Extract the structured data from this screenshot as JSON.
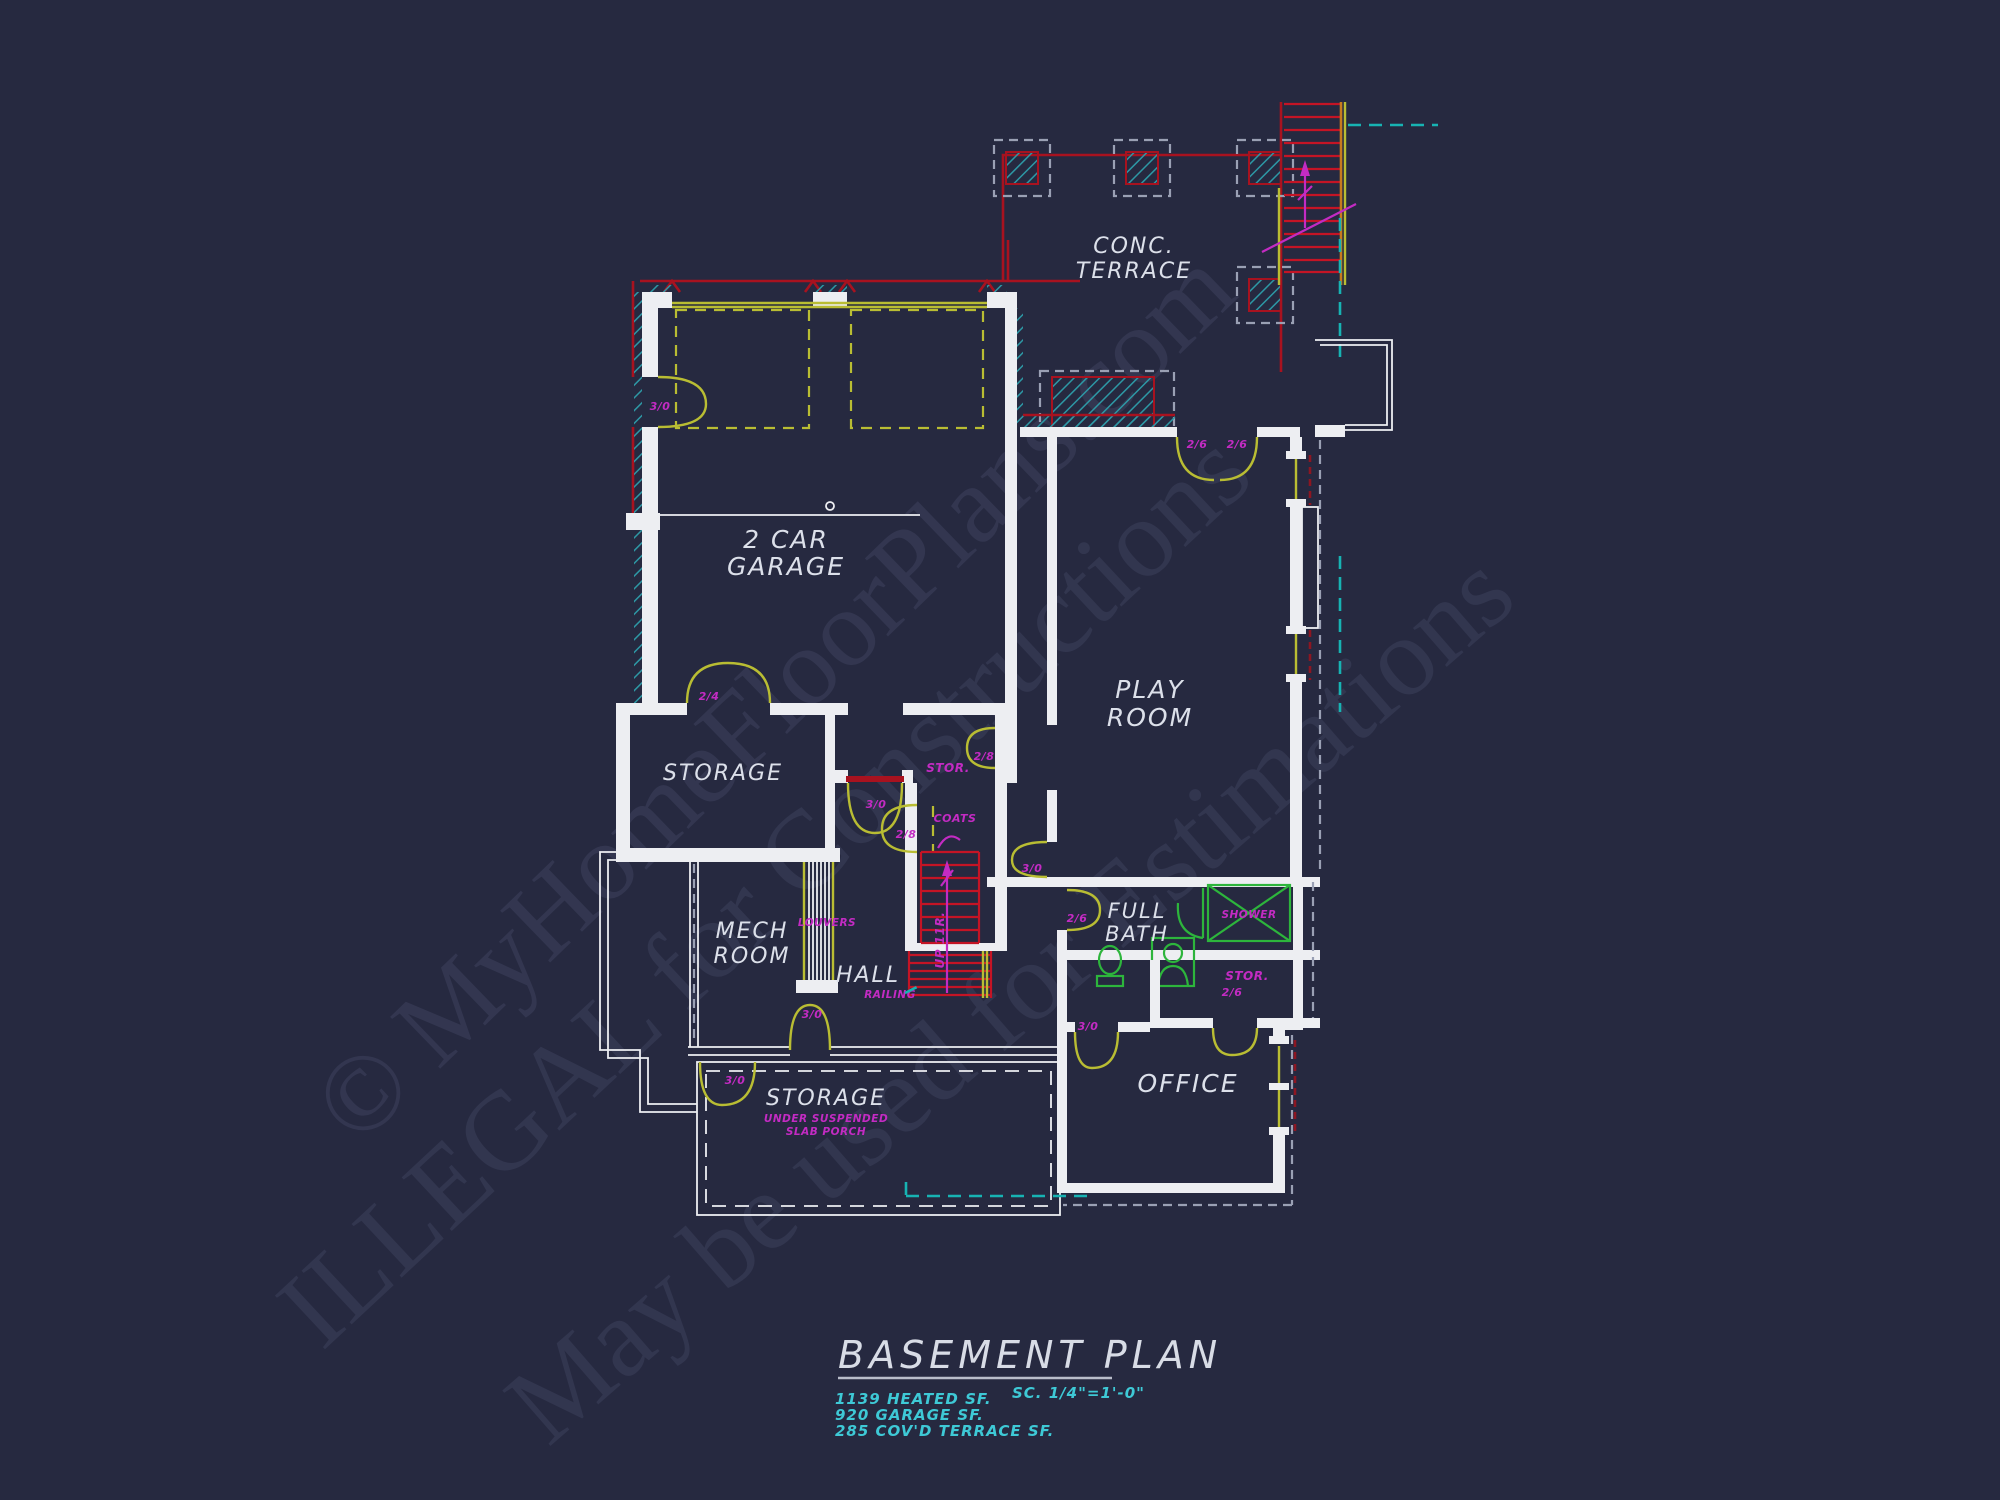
{
  "title_block": {
    "title": "BASEMENT PLAN",
    "scale": "SC. 1/4\"=1'-0\"",
    "areas": [
      "1139 HEATED SF.",
      "920 GARAGE SF.",
      "285 COV'D TERRACE SF."
    ]
  },
  "watermarks": {
    "copyright": "© MyHomeFloorPlans.com",
    "illegal": "ILLEGAL for Constructions",
    "estimation": "May be used for Estimations"
  },
  "rooms": {
    "terrace_line1": "CONC.",
    "terrace_line2": "TERRACE",
    "garage_line1": "2 CAR",
    "garage_line2": "GARAGE",
    "playroom_line1": "PLAY",
    "playroom_line2": "ROOM",
    "storage_upper": "STORAGE",
    "mech_line1": "MECH",
    "mech_line2": "ROOM",
    "hall": "HALL",
    "bath_line1": "FULL",
    "bath_line2": "BATH",
    "office": "OFFICE",
    "storage_lower": "STORAGE",
    "storage_lower_sub1": "UNDER SUSPENDED",
    "storage_lower_sub2": "SLAB PORCH",
    "stor_understair": "STOR.",
    "stor_bath": "STOR.",
    "coats": "COATS",
    "shower": "SHOWER",
    "louvers": "LOUVERS",
    "railing": "RAILING",
    "stairs_up": "UP 11R."
  },
  "doors": {
    "garage_side": "3/0",
    "storage_top": "2/4",
    "garage_hall": "3/0",
    "stair_hall": "2/8",
    "understair": "2/8",
    "playroom_left": "2/6",
    "playroom_right": "2/6",
    "hall_playroom": "3/0",
    "bath": "2/6",
    "bath_stor": "2/6",
    "hall_storage": "3/0",
    "porch_storage": "3/0"
  },
  "colors": {
    "background": "#262940",
    "wall": "#edeef2",
    "red": "#a8121f",
    "dred": "#8c1622",
    "yellow": "#b9bd33",
    "magenta": "#c32bc3",
    "teal": "#2d98a5",
    "tdash": "#17b3b3",
    "green": "#2db53c",
    "orange": "#c77b1e",
    "tread": "#c41425",
    "gdash": "#9aa0b4",
    "cyan": "#3ec9d6",
    "ttext": "#d8dce6",
    "wm": "#8991bd"
  }
}
